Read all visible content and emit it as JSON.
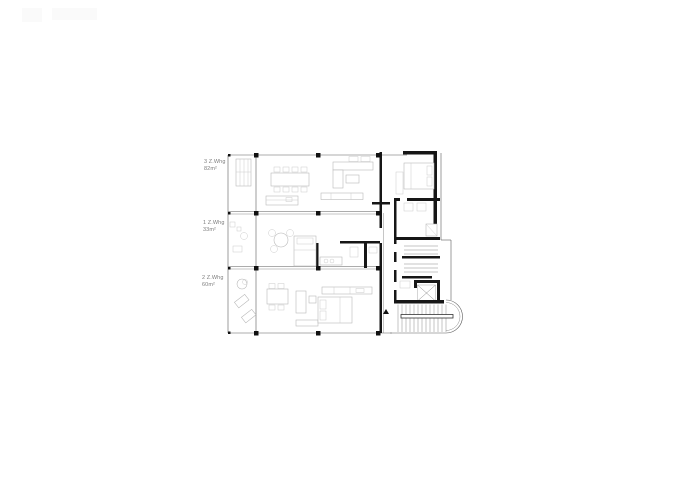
{
  "sheet": {
    "background": "#ffffff",
    "type": "architectural-floor-plan"
  },
  "apartments": [
    {
      "label": "3 Z.Whg",
      "area": "82m²"
    },
    {
      "label": "1 Z.Whg",
      "area": "33m²"
    },
    {
      "label": "2 Z.Whg",
      "area": "60m²"
    }
  ],
  "colors": {
    "wall": "#161616",
    "structure_line": "#5a5a5a",
    "furniture_line": "#b3b3b3",
    "label_text": "#7d7d7d"
  },
  "icons": {
    "entrance_marker": "black-triangle",
    "elevator": "square-with-x",
    "stair": "treads-with-half-round-end"
  }
}
